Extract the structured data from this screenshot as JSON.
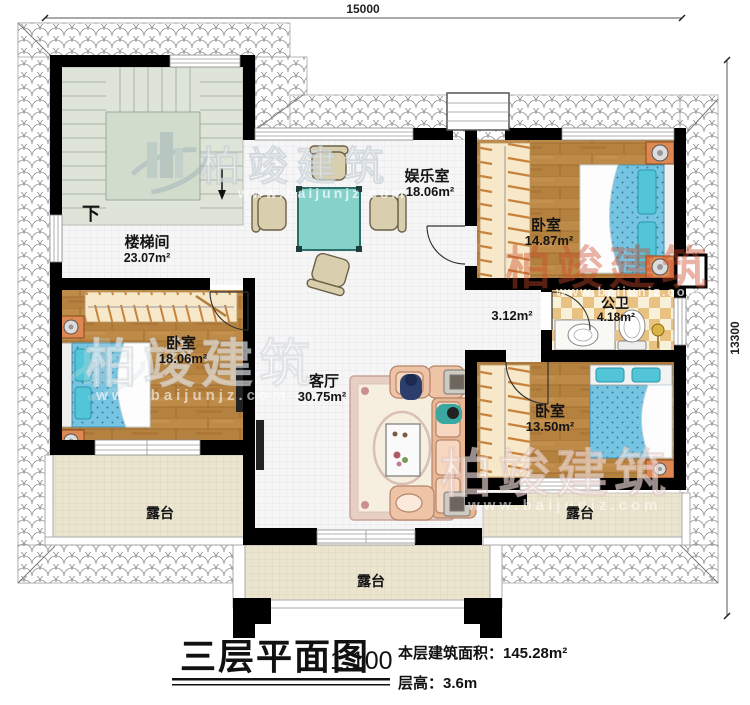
{
  "watermark": {
    "brand": "柏竣建筑",
    "url": "www.baijunjz.com"
  },
  "dimensions": {
    "width": "15000",
    "height": "13300"
  },
  "stairwell": {
    "label": "楼梯间",
    "area": "23.07m²",
    "direction": "下"
  },
  "rooms": {
    "entertainment": {
      "label": "娱乐室",
      "area": "18.06m²"
    },
    "bedroom_top_right": {
      "label": "卧室",
      "area": "14.87m²"
    },
    "bathroom": {
      "label": "公卫",
      "area": "4.18m²"
    },
    "corridor": {
      "area": "3.12m²"
    },
    "bedroom_left": {
      "label": "卧室",
      "area": "18.06m²"
    },
    "living_room": {
      "label": "客厅",
      "area": "30.75m²"
    },
    "bedroom_bottom_right": {
      "label": "卧室",
      "area": "13.50m²"
    },
    "terrace_left": {
      "label": "露台"
    },
    "terrace_right": {
      "label": "露台"
    },
    "terrace_bottom": {
      "label": "露台"
    }
  },
  "title_block": {
    "title": "三层平面图",
    "scale": "1:100",
    "floor_area": "本层建筑面积：145.28m²",
    "floor_height": "层高：3.6m"
  },
  "colors": {
    "wall": "#000000",
    "wood_floor": "#b5813f",
    "bed_blue": "#74c4e2",
    "checker_tan": "#e9c181",
    "terrace_floor": "#ebe5cf",
    "table_teal": "#85d2cb",
    "sofa_salmon": "#efc3a6",
    "stair_green": "#dfe4d9"
  }
}
